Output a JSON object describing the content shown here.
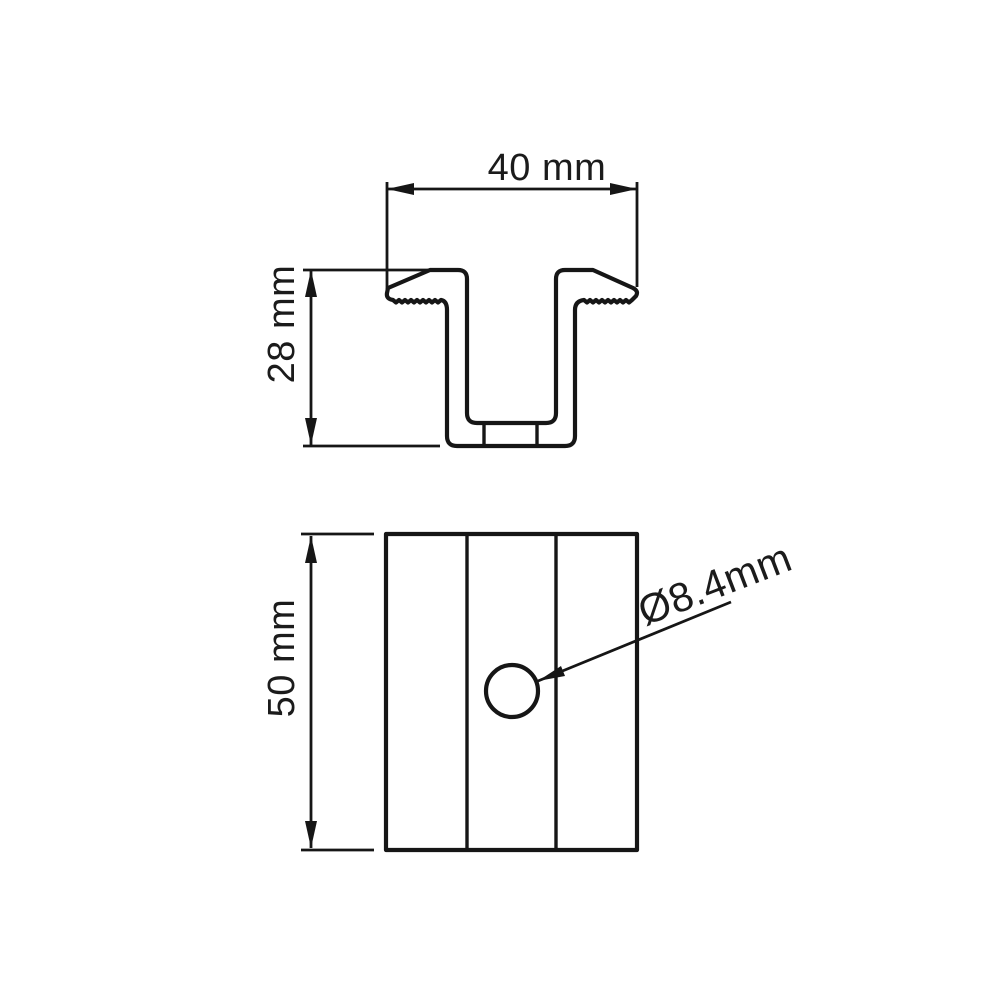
{
  "page": {
    "background_color": "#ffffff",
    "line_color": "#161616"
  },
  "drawing": {
    "type": "technical-dimension-drawing",
    "top_view": {
      "width_label": "40 mm",
      "height_label": "28 mm"
    },
    "bottom_view": {
      "length_label": "50 mm",
      "hole_diameter_label": "Ø8.4mm"
    },
    "dimensions_mm": {
      "width": 40,
      "height": 28,
      "length": 50,
      "hole_diameter": 8.4
    }
  }
}
